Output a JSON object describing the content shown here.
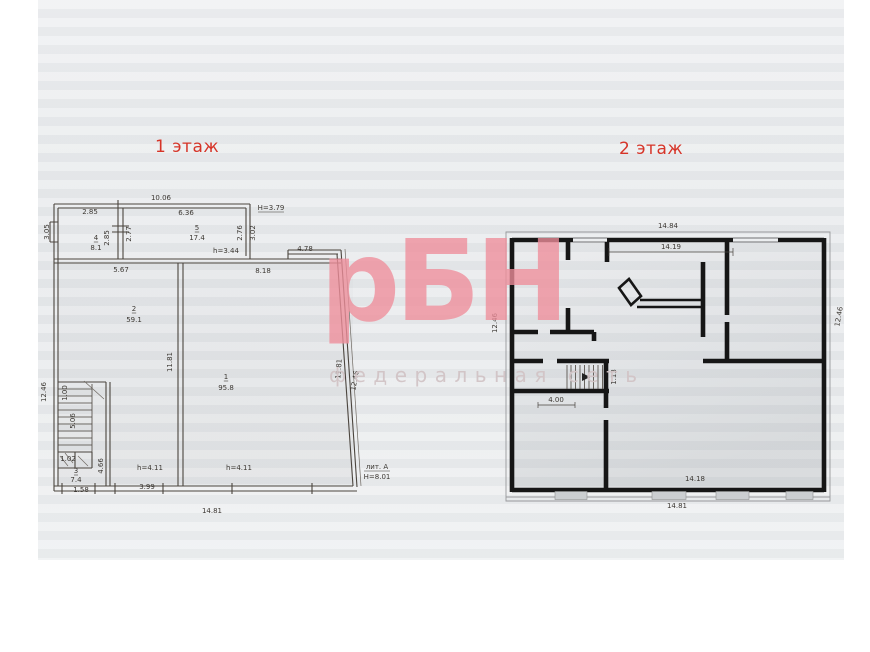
{
  "titles": {
    "floor1": "1 этаж",
    "floor2": "2 этаж"
  },
  "watermark": {
    "logo": "рБН",
    "tagline": "федеральная сеть"
  },
  "colors": {
    "title_red": "#d63428",
    "watermark_pink": "#ef8e9b",
    "watermark_tagline": "#d2c4c6",
    "floor1_line": "#4b453e",
    "floor2_wall": "#161616",
    "paper": "#eaecee"
  },
  "floor1": {
    "labels": [
      {
        "t": "10.06",
        "x": 161,
        "y": 200
      },
      {
        "t": "2.85",
        "x": 90,
        "y": 214
      },
      {
        "t": "6.36",
        "x": 186,
        "y": 215
      },
      {
        "t": "Н=3.79",
        "x": 271,
        "y": 210,
        "u": true
      },
      {
        "t": "3.05",
        "x": 49,
        "y": 232,
        "r": -90
      },
      {
        "t": "2.85",
        "x": 109,
        "y": 238,
        "r": -90
      },
      {
        "t": "2.77",
        "x": 131,
        "y": 234,
        "r": -90
      },
      {
        "t": "4",
        "x": 96,
        "y": 240,
        "u": true
      },
      {
        "t": "8.1",
        "x": 96,
        "y": 250
      },
      {
        "t": "5",
        "x": 197,
        "y": 230,
        "u": true
      },
      {
        "t": "17.4",
        "x": 197,
        "y": 240
      },
      {
        "t": "h=3.44",
        "x": 226,
        "y": 253
      },
      {
        "t": "2.76",
        "x": 242,
        "y": 233,
        "r": -90
      },
      {
        "t": "3.02",
        "x": 255,
        "y": 233,
        "r": -90
      },
      {
        "t": "4.78",
        "x": 305,
        "y": 251
      },
      {
        "t": "5.67",
        "x": 121,
        "y": 272
      },
      {
        "t": "8.18",
        "x": 263,
        "y": 273
      },
      {
        "t": "2",
        "x": 134,
        "y": 311,
        "u": true
      },
      {
        "t": "59.1",
        "x": 134,
        "y": 322
      },
      {
        "t": "1",
        "x": 226,
        "y": 379,
        "u": true
      },
      {
        "t": "95.8",
        "x": 226,
        "y": 390
      },
      {
        "t": "11.81",
        "x": 172,
        "y": 362,
        "r": -90
      },
      {
        "t": "11.81",
        "x": 341,
        "y": 369,
        "r": -86
      },
      {
        "t": "12.46",
        "x": 357,
        "y": 381,
        "r": -80
      },
      {
        "t": "12.46",
        "x": 46,
        "y": 392,
        "r": -90
      },
      {
        "t": "1.00",
        "x": 67,
        "y": 393,
        "r": -90,
        "fs": 6
      },
      {
        "t": "5.06",
        "x": 75,
        "y": 421,
        "r": -90,
        "fs": 6
      },
      {
        "t": "1.02",
        "x": 68,
        "y": 461,
        "fs": 5.5
      },
      {
        "t": "3",
        "x": 76,
        "y": 473,
        "u": true,
        "fs": 6.5
      },
      {
        "t": "7.4",
        "x": 76,
        "y": 482,
        "fs": 6.5
      },
      {
        "t": "1.58",
        "x": 81,
        "y": 492,
        "fs": 6.5
      },
      {
        "t": "4.66",
        "x": 103,
        "y": 466,
        "r": -90
      },
      {
        "t": "h=4.11",
        "x": 150,
        "y": 470
      },
      {
        "t": "h=4.11",
        "x": 239,
        "y": 470
      },
      {
        "t": "3.99",
        "x": 147,
        "y": 489
      },
      {
        "t": "14.81",
        "x": 212,
        "y": 513
      },
      {
        "t": "лит. А",
        "x": 377,
        "y": 469,
        "u": true
      },
      {
        "t": "Н=8.01",
        "x": 377,
        "y": 479
      }
    ]
  },
  "floor2": {
    "labels": [
      {
        "t": "14.84",
        "x": 668,
        "y": 228
      },
      {
        "t": "14.19",
        "x": 671,
        "y": 249
      },
      {
        "t": "12.46",
        "x": 497,
        "y": 323,
        "r": -90
      },
      {
        "t": "12.46",
        "x": 841,
        "y": 317,
        "r": -80
      },
      {
        "t": "4.00",
        "x": 556,
        "y": 402
      },
      {
        "t": "1.13",
        "x": 616,
        "y": 377,
        "r": -90
      },
      {
        "t": "14.18",
        "x": 695,
        "y": 481
      },
      {
        "t": "14.81",
        "x": 677,
        "y": 508
      }
    ]
  }
}
